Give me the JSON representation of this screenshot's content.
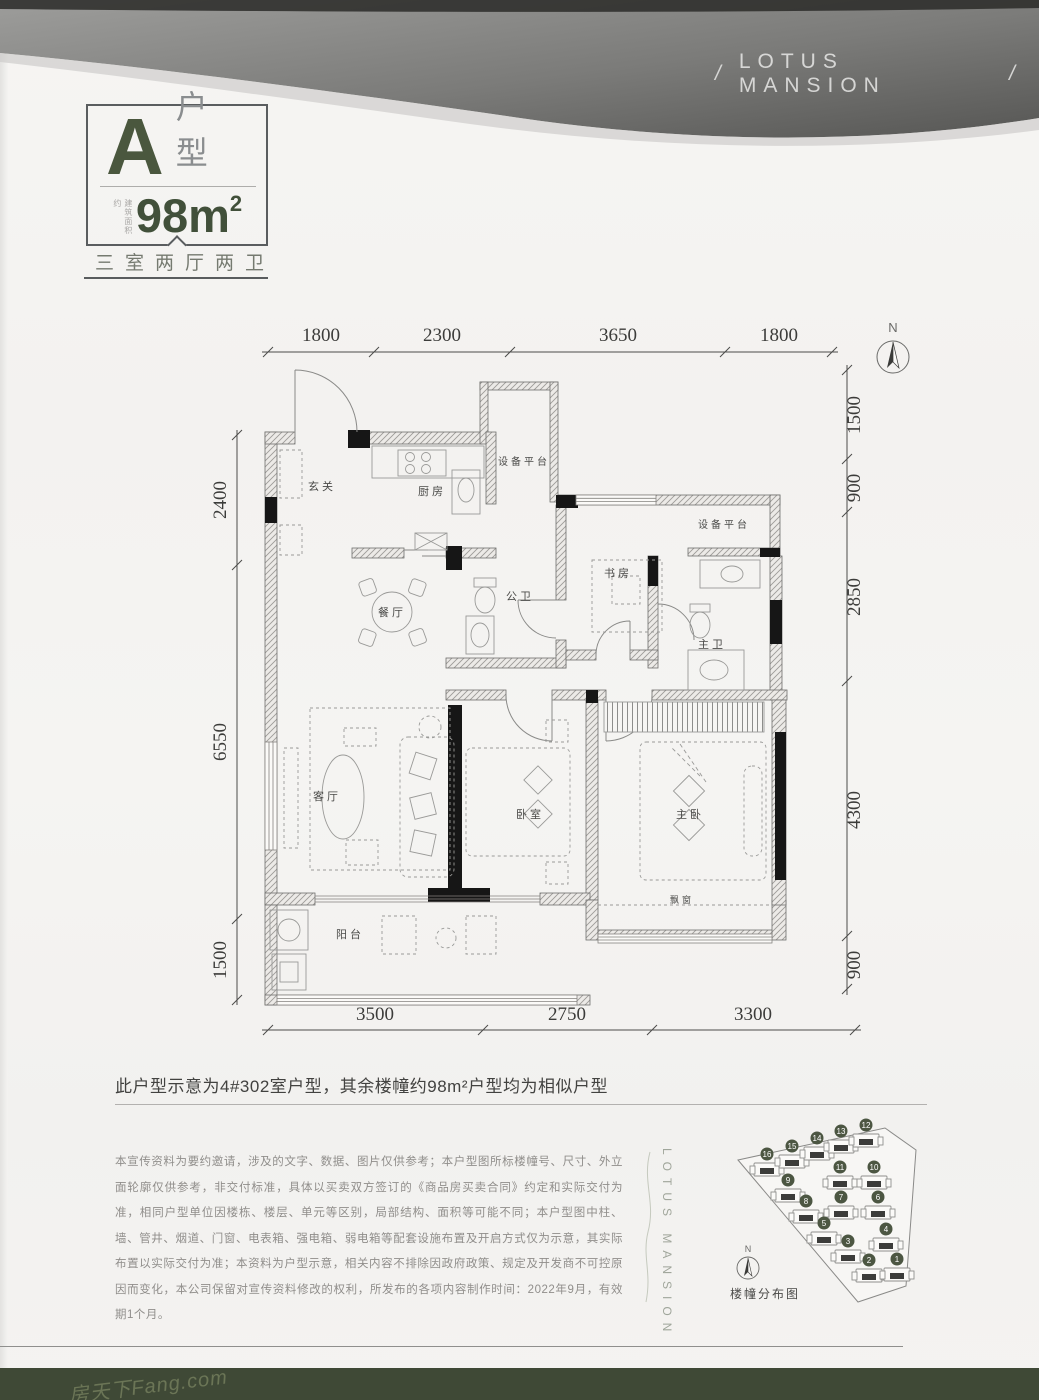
{
  "header": {
    "slash_left": "/",
    "brand": "LOTUS MANSION",
    "slash_right": "/"
  },
  "badge": {
    "type_letter": "A",
    "type_label": "户型",
    "area_side_label": "建筑面积约",
    "area_value": "98m",
    "area_sup": "2",
    "layout_label": "三室两厅两卫"
  },
  "plan": {
    "compass_label": "N",
    "rooms": {
      "entry": "玄关",
      "kitchen": "厨房",
      "equip_top": "设备平台",
      "public_bath": "公卫",
      "dining": "餐厅",
      "study": "书房",
      "equip_right": "设备平台",
      "master_bath": "主卫",
      "living": "客厅",
      "bedroom": "卧室",
      "master_bedroom": "主卧",
      "balcony": "阳台",
      "bay_window": "飘窗"
    },
    "dims": {
      "top": [
        "1800",
        "2300",
        "3650",
        "1800"
      ],
      "bottom": [
        "3500",
        "2750",
        "3300"
      ],
      "left": [
        "2400",
        "6550",
        "1500"
      ],
      "right": [
        "1500",
        "900",
        "2850",
        "4300",
        "900"
      ]
    }
  },
  "note": "此户型示意为4#302室户型，其余楼幢约98m²户型均为相似户型",
  "disclaimer": "本宣传资料为要约邀请，涉及的文字、数据、图片仅供参考；本户型图所标楼幢号、尺寸、外立面轮廓仅供参考，非交付标准，具体以买卖双方签订的《商品房买卖合同》约定和实际交付为准，相同户型单位因楼栋、楼层、单元等区别，局部结构、面积等可能不同；本户型图中柱、墙、管井、烟道、门窗、电表箱、强电箱、弱电箱等配套设施布置及开启方式仅为示意，其实际布置以实际交付为准；本资料为户型示意，相关内容不排除因政府政策、规定及开发商不可控原因而变化，本公司保留对宣传资料修改的权利，所发布的各项内容制作时间：2022年9月，有效期1个月。",
  "site_plan": {
    "brand_vertical": "LOTUS MANSION",
    "compass_label": "N",
    "caption": "楼幢分布图",
    "buildings": [
      {
        "num": "16",
        "x": 767,
        "y": 1165
      },
      {
        "num": "15",
        "x": 792,
        "y": 1157
      },
      {
        "num": "14",
        "x": 817,
        "y": 1149
      },
      {
        "num": "13",
        "x": 841,
        "y": 1142
      },
      {
        "num": "12",
        "x": 866,
        "y": 1136
      },
      {
        "num": "11",
        "x": 840,
        "y": 1178
      },
      {
        "num": "10",
        "x": 874,
        "y": 1178
      },
      {
        "num": "9",
        "x": 788,
        "y": 1191
      },
      {
        "num": "8",
        "x": 806,
        "y": 1212
      },
      {
        "num": "7",
        "x": 841,
        "y": 1208
      },
      {
        "num": "6",
        "x": 878,
        "y": 1208
      },
      {
        "num": "5",
        "x": 824,
        "y": 1234
      },
      {
        "num": "4",
        "x": 886,
        "y": 1240
      },
      {
        "num": "3",
        "x": 848,
        "y": 1252
      },
      {
        "num": "2",
        "x": 869,
        "y": 1271
      },
      {
        "num": "1",
        "x": 897,
        "y": 1270
      }
    ]
  },
  "watermark": "房天下Fang.com",
  "colors": {
    "accent_green": "#48543d",
    "band_green": "#3f4936",
    "ribbon_gray": "#6e6e6c"
  }
}
